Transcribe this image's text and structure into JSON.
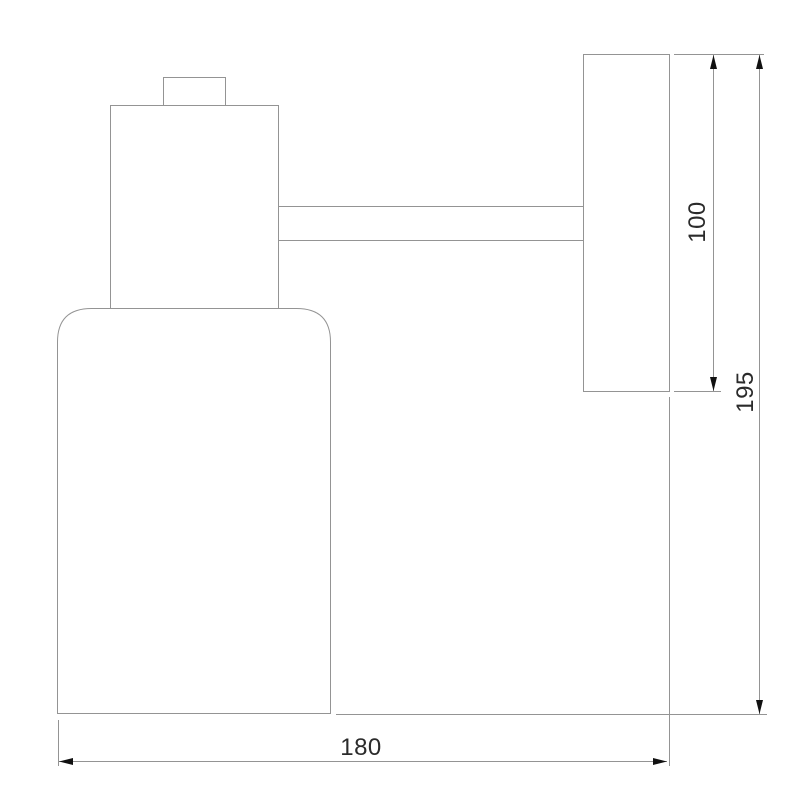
{
  "drawing": {
    "labels": {
      "plate_height": "100",
      "overall_height": "195",
      "overall_width": "180"
    }
  },
  "colors": {
    "background": "#ffffff",
    "outline": "#949494",
    "dimension_line": "#949494",
    "arrow": "#111111",
    "text": "#2b2b2b"
  }
}
